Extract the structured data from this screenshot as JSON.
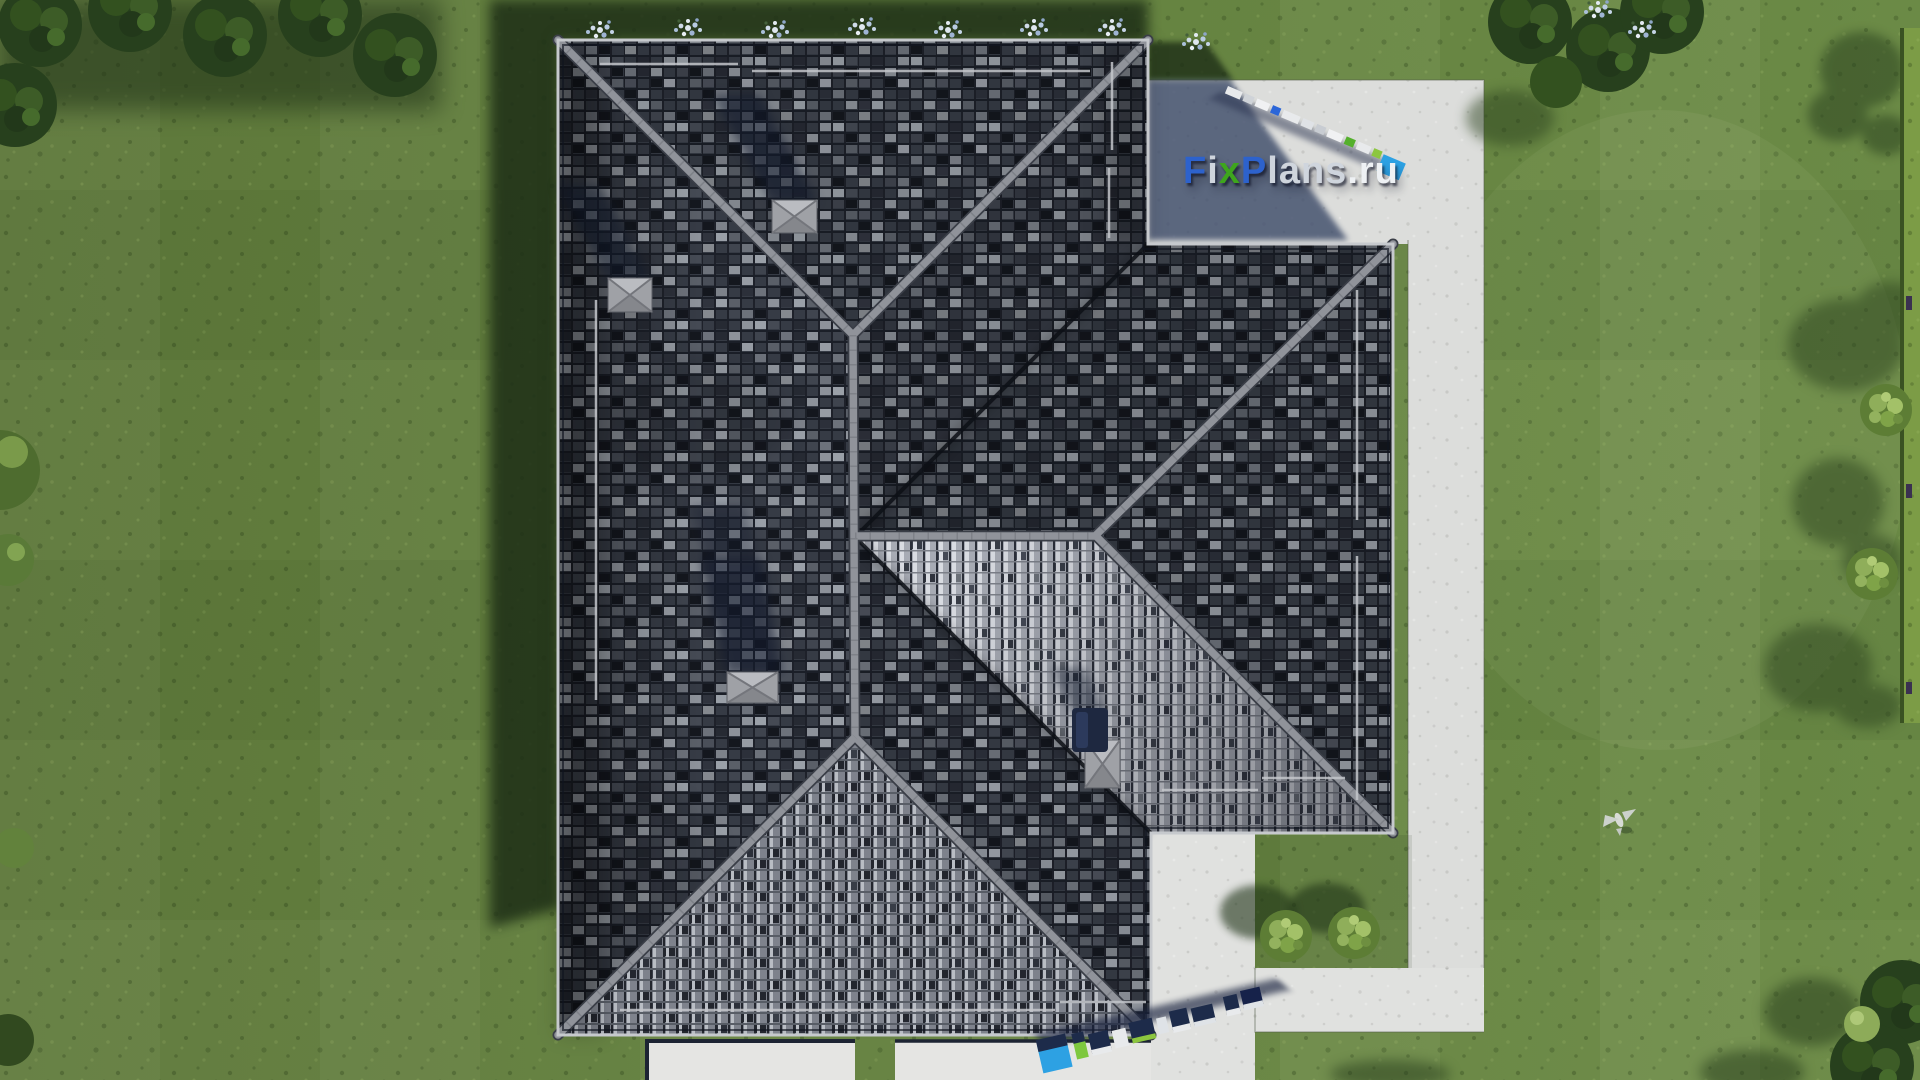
{
  "watermark": {
    "text": "FixPlans.ru",
    "parts": {
      "f": "F",
      "i": "i",
      "x": "x",
      "p": "P",
      "lans": "lans",
      "dotru": ".ru"
    },
    "colors": {
      "blue": "#2d62cc",
      "green": "#3ea51d",
      "gray": "#cfd5dd",
      "white": "#eef1f4"
    }
  },
  "scene": {
    "view": "top-down aerial render",
    "house": {
      "roof_type": "hip roof with right wing",
      "tile_colors": [
        "#14171e",
        "#363b45",
        "#6d727b",
        "#8d929a",
        "#a7abb4"
      ],
      "ridge_color": "#90939a",
      "roof_vents": 4,
      "chimney_pipe_color": "#1e2840"
    },
    "landscape": {
      "lawn_color": "#64813f",
      "lawn_shadow_color": "#1e2f17",
      "concrete_color": "#dcdddb",
      "concrete_shadow_color": "#3c4a68",
      "courtyard_bushes": 2,
      "right_side_bushes": 2,
      "hedge": "right edge",
      "flower_clusters_top": 8,
      "bird_on_lawn": 1
    },
    "standing_logo_strips": 2
  }
}
